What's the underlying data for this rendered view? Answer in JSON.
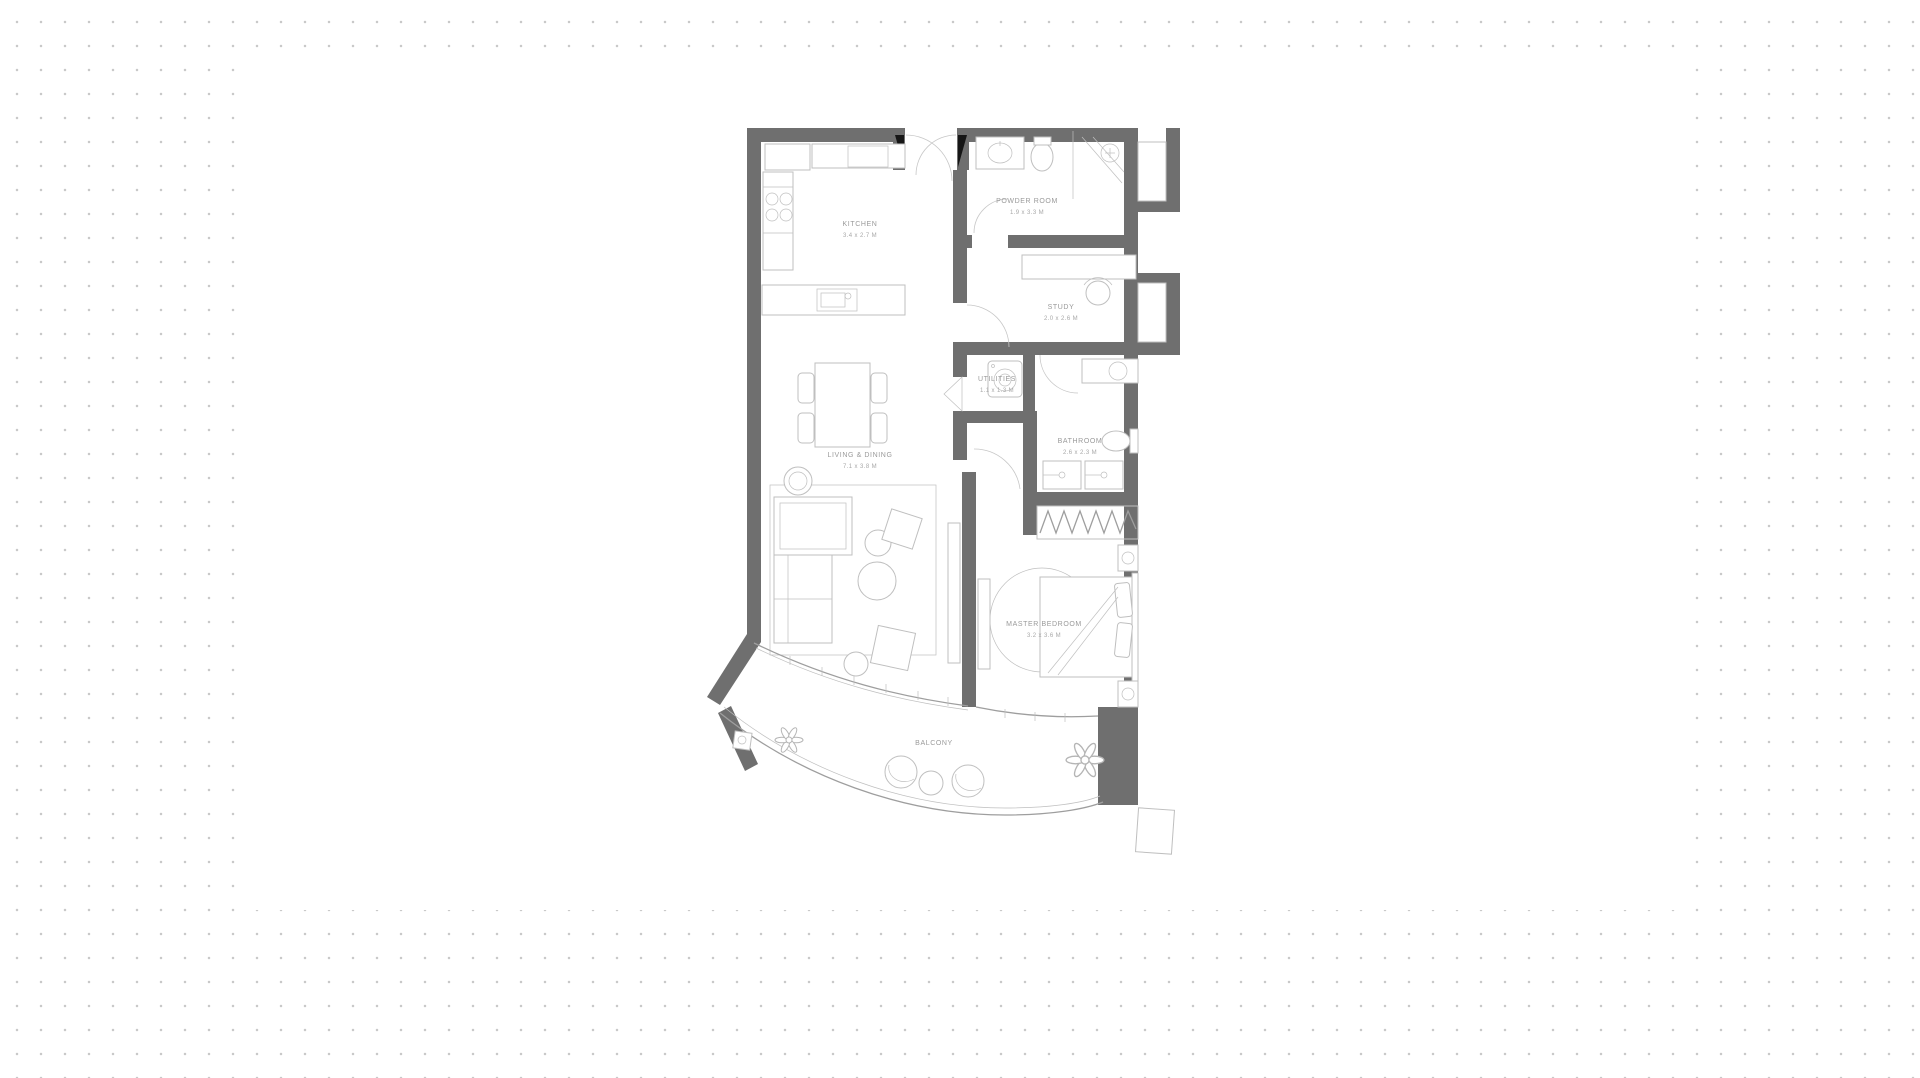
{
  "canvas": {
    "width": 1920,
    "height": 1078
  },
  "colors": {
    "page_bg": "#ffffff",
    "dot": "#c9c9c9",
    "card_bg": "#ffffff",
    "wall": "#6f6f6f",
    "line": "#bfbfbf",
    "line_dark": "#9e9e9e",
    "label": "#9a9a9a",
    "door_black": "#161616"
  },
  "floor_plan": {
    "type": "apartment-unit-floor-plan",
    "rooms": [
      {
        "id": "kitchen",
        "label": "KITCHEN",
        "dims": "3.4 x 2.7 M"
      },
      {
        "id": "powder-room",
        "label": "POWDER ROOM",
        "dims": "1.9 x 3.3 M"
      },
      {
        "id": "study",
        "label": "STUDY",
        "dims": "2.0 x 2.6 M"
      },
      {
        "id": "utilities",
        "label": "UTILITIES",
        "dims": "1.1 x 1.3 M"
      },
      {
        "id": "bathroom",
        "label": "BATHROOM",
        "dims": "2.6 x 2.3 M"
      },
      {
        "id": "living-dining",
        "label": "LIVING & DINING",
        "dims": "7.1 x 3.8 M"
      },
      {
        "id": "master-bedroom",
        "label": "MASTER BEDROOM",
        "dims": "3.2 x 3.6 M"
      },
      {
        "id": "balcony",
        "label": "BALCONY",
        "dims": ""
      }
    ]
  }
}
